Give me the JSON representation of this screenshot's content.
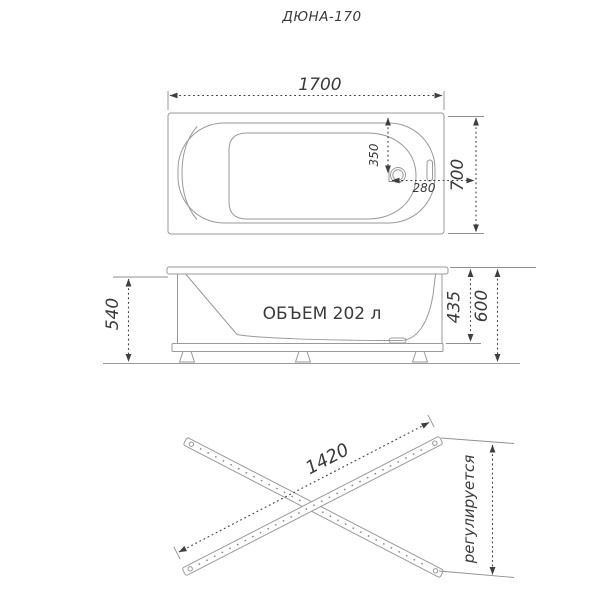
{
  "title": "ДЮНА-170",
  "colors": {
    "background": "#ffffff",
    "drawing_lines": "#9a9a9a",
    "dimension_lines": "#3f3f3f",
    "text": "#3a3a3a"
  },
  "top_view": {
    "length_label": "1700",
    "width_label": "700",
    "drain_from_end_label": "350",
    "drain_from_side_label": "280"
  },
  "side_view": {
    "volume_label": "ОБЪЕМ 202 л",
    "rim_to_floor_label": "540",
    "rim_to_frame_label": "435",
    "total_height_label": "600"
  },
  "frame_view": {
    "rail_length_label": "1420",
    "adjustable_label": "регулируется"
  }
}
